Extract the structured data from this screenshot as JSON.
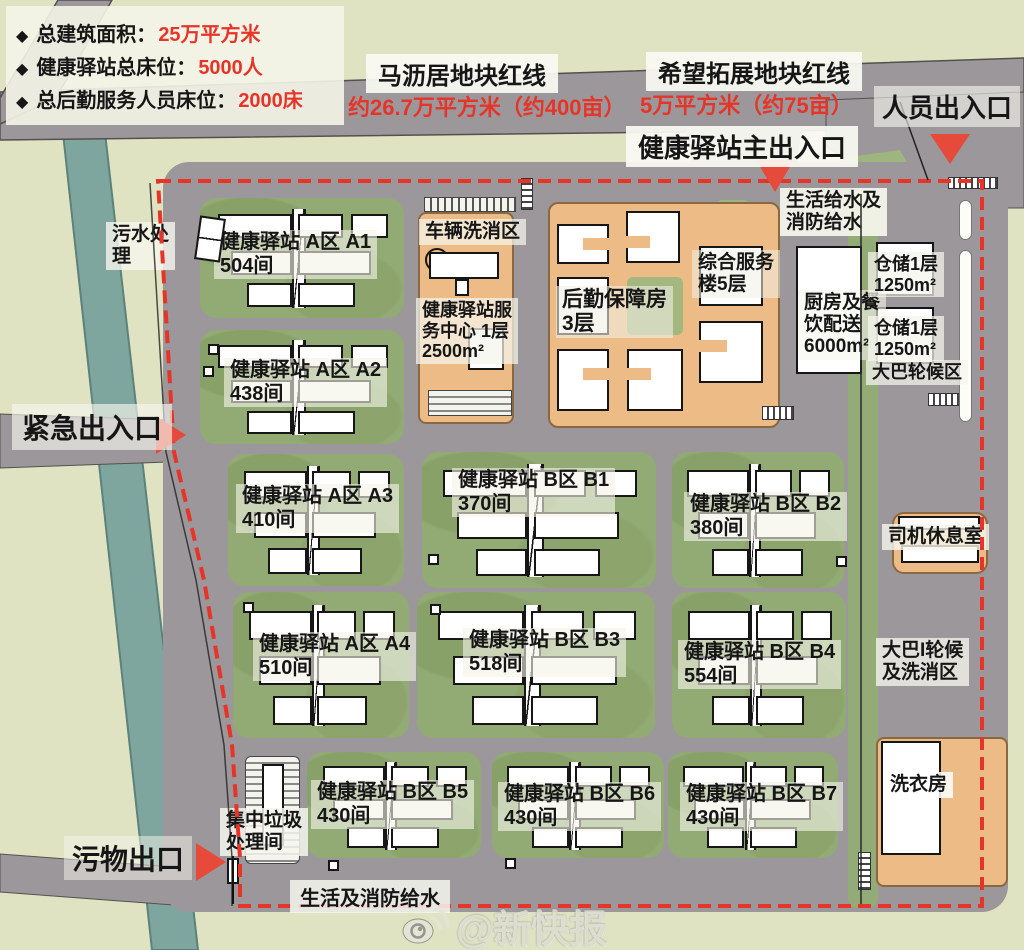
{
  "legend": {
    "items": [
      {
        "bullet": "◆",
        "label": "总建筑面积：",
        "value": "25万平方米"
      },
      {
        "bullet": "◆",
        "label": "健康驿站总床位：",
        "value": "5000人"
      },
      {
        "bullet": "◆",
        "label": "总后勤服务人员床位：",
        "value": "2000床"
      }
    ]
  },
  "parcels": {
    "left": {
      "name": "马沥居地块红线",
      "area": "约26.7万平方米（约400亩）"
    },
    "right": {
      "name": "希望拓展地块红线",
      "area": "5万平方米（约75亩）"
    }
  },
  "entrances": {
    "person": "人员出入口",
    "main": "健康驿站主出入口",
    "emergency": "紧急出入口",
    "waste": "污物出口"
  },
  "facilities": {
    "sewage": "污水处\n理",
    "vehicle_wash": "车辆洗消区",
    "service_center": "健康驿站服\n务中心 1层\n2500m²",
    "logistics": "后勤保障房\n3层",
    "complex": "综合服务\n楼5层",
    "kitchen": "厨房及餐\n饮配送\n6000m²",
    "water_top": "生活给水及\n消防给水",
    "storage1": "仓储1层\n1250m²",
    "storage2": "仓储1层\n1250m²",
    "bus_wait": "大巴轮候区",
    "driver_rest": "司机休息室",
    "bus_wash": "大巴I轮候\n及洗消区",
    "laundry": "洗衣房",
    "garbage": "集中垃圾\n处理间",
    "water_bottom": "生活及消防给水"
  },
  "blocks": [
    {
      "name": "健康驿站 A区 A1",
      "rooms": "504间"
    },
    {
      "name": "健康驿站 A区 A2",
      "rooms": "438间"
    },
    {
      "name": "健康驿站 A区 A3",
      "rooms": "410间"
    },
    {
      "name": "健康驿站 A区 A4",
      "rooms": "510间"
    },
    {
      "name": "健康驿站 B区 B1",
      "rooms": "370间"
    },
    {
      "name": "健康驿站 B区 B2",
      "rooms": "380间"
    },
    {
      "name": "健康驿站 B区 B3",
      "rooms": "518间"
    },
    {
      "name": "健康驿站 B区 B4",
      "rooms": "554间"
    },
    {
      "name": "健康驿站 B区 B5",
      "rooms": "430间"
    },
    {
      "name": "健康驿站 B区 B6",
      "rooms": "430间"
    },
    {
      "name": "健康驿站 B区 B7",
      "rooms": "430间"
    }
  ],
  "watermark": {
    "handle": "@新快报"
  },
  "colors": {
    "accent_red": "#e63428",
    "road_gray": "#9c979a",
    "block_green": "#92aa74",
    "building_orange": "#edbc86",
    "river_teal": "#7ea69f",
    "background_green": "#dfe3c2"
  }
}
